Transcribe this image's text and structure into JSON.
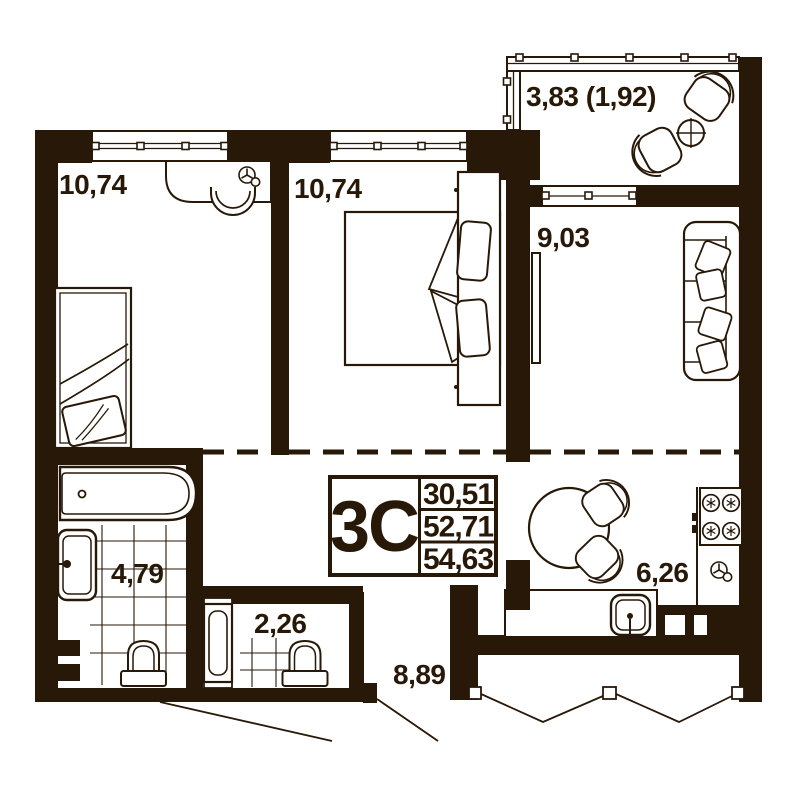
{
  "info_box": {
    "type_label": "3С",
    "living_area": "30,51",
    "total_area": "52,71",
    "total_area_with_balcony": "54,63"
  },
  "rooms": {
    "bedroom1": {
      "area": "10,74"
    },
    "bedroom2": {
      "area": "10,74"
    },
    "balcony": {
      "area": "3,83 (1,92)"
    },
    "living": {
      "area": "9,03"
    },
    "kitchen": {
      "area": "6,26"
    },
    "bathroom": {
      "area": "4,79"
    },
    "wc": {
      "area": "2,26"
    },
    "hallway": {
      "area": "8,89"
    }
  },
  "icons": {
    "fan": "ventilation-fan-symbol",
    "burner": "stove-burner-symbol"
  },
  "colors": {
    "ink": "#281808",
    "background": "#ffffff"
  }
}
